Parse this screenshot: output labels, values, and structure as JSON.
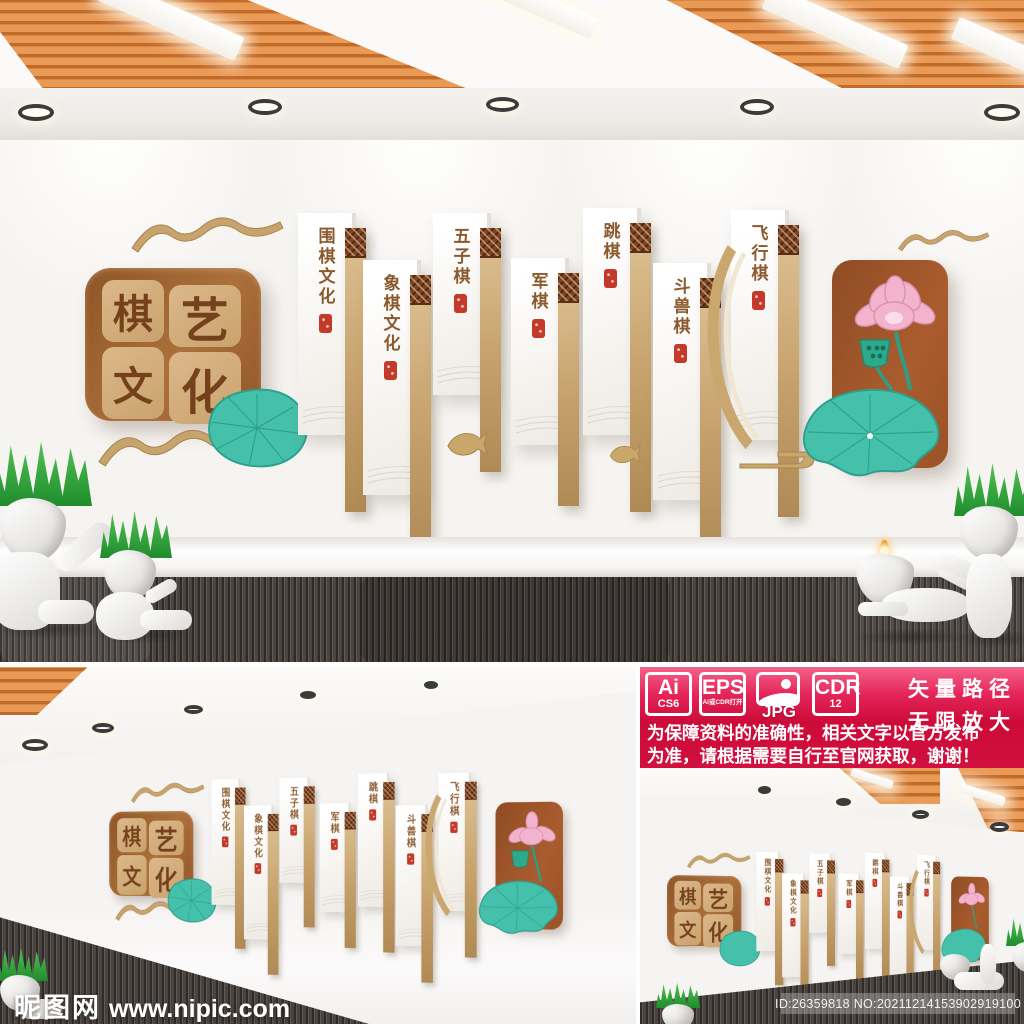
{
  "wall": {
    "title": {
      "c0": "棋",
      "c1": "艺",
      "c2": "文",
      "c3": "化"
    },
    "panels": [
      {
        "label": "围棋文化"
      },
      {
        "label": "象棋文化"
      },
      {
        "label": "五子棋"
      },
      {
        "label": "军棋"
      },
      {
        "label": "跳棋"
      },
      {
        "label": "斗兽棋"
      },
      {
        "label": "飞行棋"
      }
    ]
  },
  "banner": {
    "badges": [
      {
        "line1": "Ai",
        "line2": "CS6"
      },
      {
        "line1": "EPS",
        "line2": "AI或CDR打开"
      },
      {
        "line1": "JPG",
        "line2": ""
      },
      {
        "line1": "CDR",
        "line2": "12"
      }
    ],
    "slogan1": "矢量路径",
    "slogan2": "无限放大",
    "notice1": "为保障资料的准确性，相关文字以官方发布",
    "notice2": "为准，请根据需要自行至官网获取，谢谢！"
  },
  "watermark": {
    "logo": "昵图网",
    "url": "www.nipic.com"
  },
  "id_bar": {
    "text": "ID:26359818 NO:20211214153902919100"
  },
  "colors": {
    "banner_pink": "#f4628a",
    "banner_red": "#cc0b38",
    "panel_brown": "#9a5a2c",
    "tile_tan": "#d2ad7c",
    "strip_gold": "#c9a76a",
    "leaf_teal": "#45c0ab",
    "lotus_pink": "#f2b3cc",
    "seal_red": "#c33a2a",
    "slat_orange": "#d9853f"
  }
}
